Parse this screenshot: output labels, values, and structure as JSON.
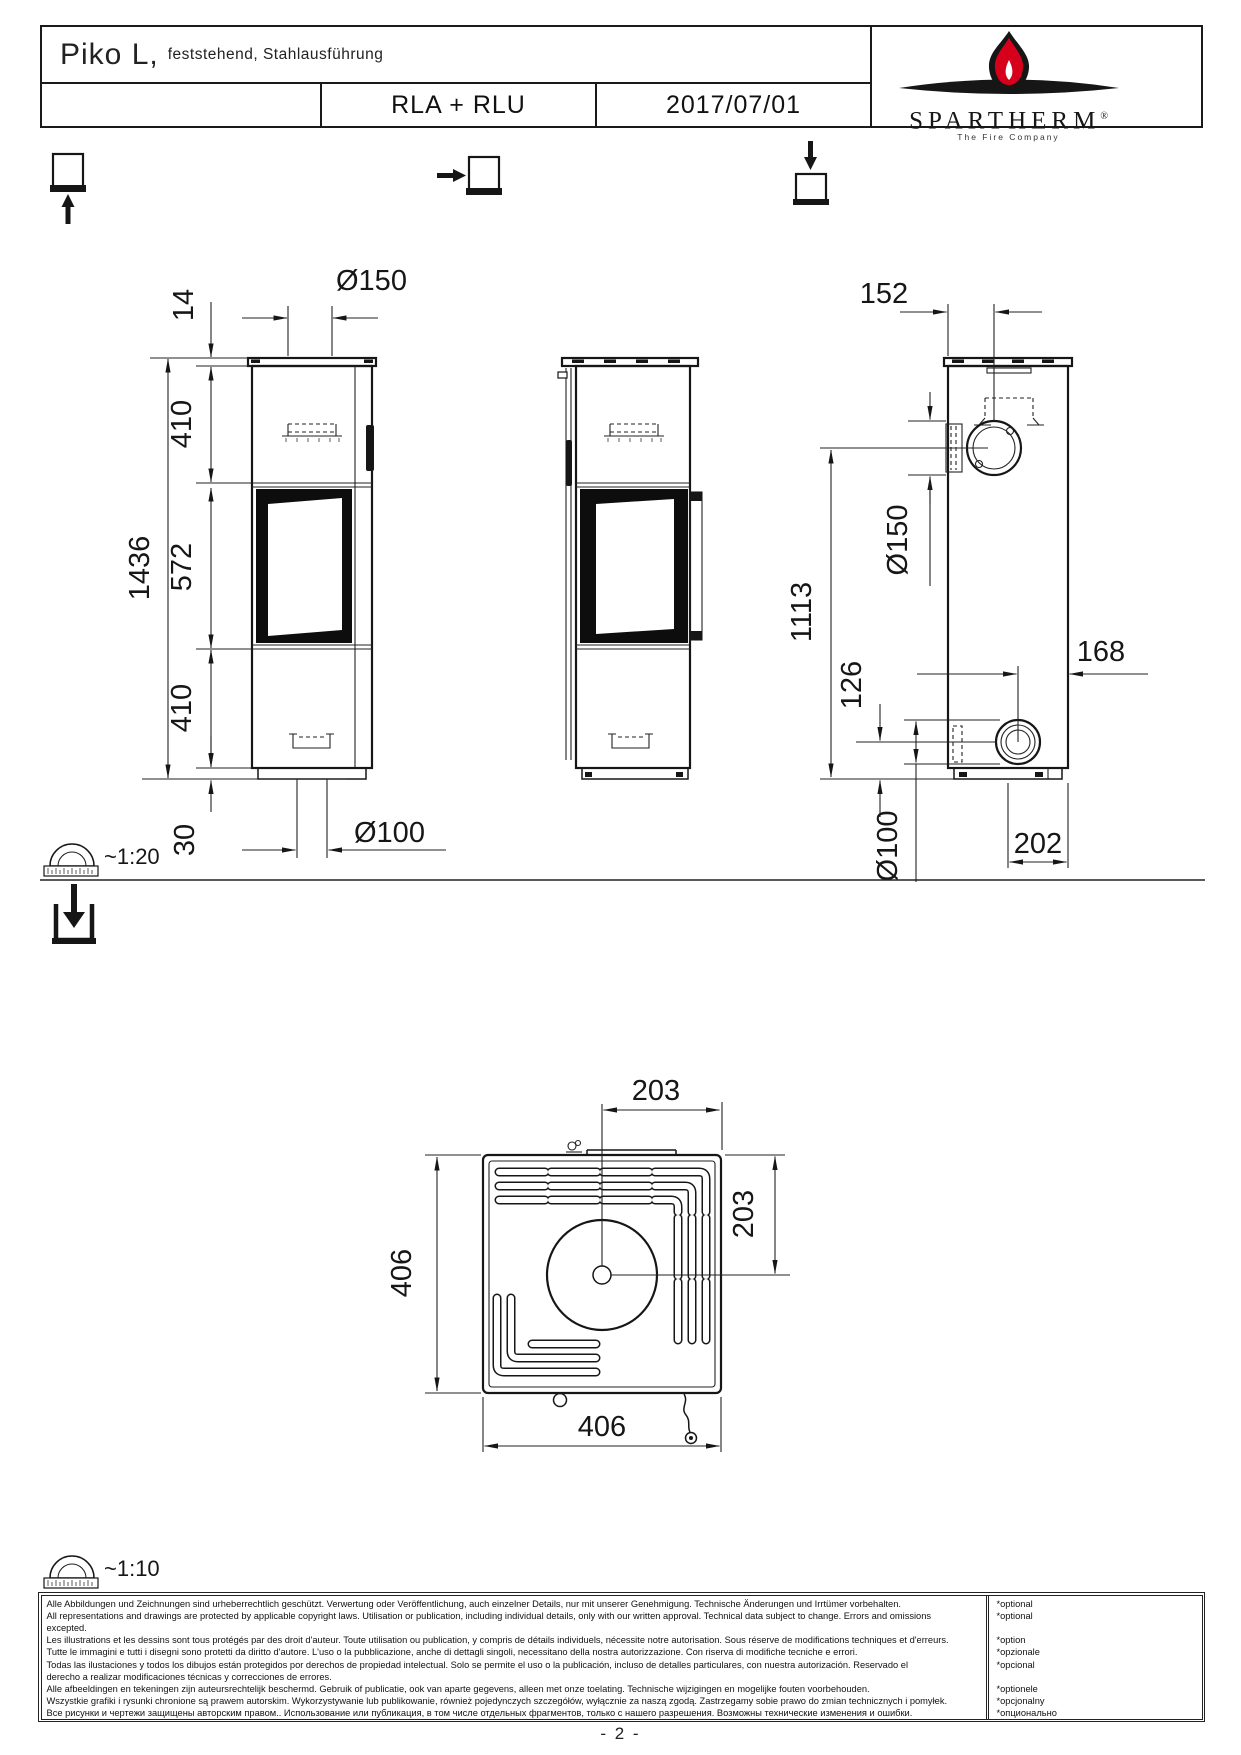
{
  "header": {
    "title": "Piko L,",
    "subtitle": "feststehend, Stahlausführung",
    "model_row": {
      "variant": "RLA + RLU",
      "date": "2017/07/01"
    },
    "brand": {
      "name": "SPARTHERM",
      "registered": "®",
      "tagline": "The Fire Company"
    }
  },
  "views": {
    "front": {
      "dims": {
        "plate_height": "14",
        "upper_height": "410",
        "total_height": "1436",
        "window_height": "572",
        "lower_height": "410",
        "base_height": "30",
        "flue_diameter": "Ø150",
        "air_inlet_diameter": "Ø100"
      }
    },
    "back": {
      "dims": {
        "flue_offset": "152",
        "flue_center_height": "1113",
        "flue_diameter": "Ø150",
        "air_center_height": "126",
        "air_offset": "168",
        "air_diameter": "Ø100",
        "base_depth": "202"
      }
    },
    "top": {
      "dims": {
        "flue_offset_x": "203",
        "flue_offset_y": "203",
        "width": "406",
        "depth": "406"
      }
    }
  },
  "scales": {
    "elevation": "~1:20",
    "plan": "~1:10"
  },
  "disclaimer": {
    "lines": [
      "Alle Abbildungen und Zeichnungen sind urheberrechtlich geschützt. Verwertung oder Veröffentlichung, auch einzelner Details, nur mit unserer Genehmigung. Technische Änderungen und Irrtümer vorbehalten.",
      "All representations and drawings are protected by applicable copyright laws. Utilisation or publication, including individual details, only with our written approval. Technical data subject to change. Errors and omissions",
      "excepted.",
      "Les illustrations et les dessins sont tous protégés par des droit d'auteur. Toute utilisation ou publication, y compris de détails individuels, nécessite notre autorisation. Sous réserve de modifications techniques et d'erreurs.",
      "Tutte le immagini e tutti i disegni sono protetti da diritto d'autore. L'uso o la pubblicazione, anche di dettagli singoli, necessitano della nostra autorizzazione. Con riserva di modifiche tecniche e errori.",
      "Todas las ilustaciones y todos los dibujos están protegidos por derechos de propiedad intelectual. Solo se permite el uso o la publicación, incluso de detalles particulares, con nuestra autorización. Reservado el",
      "derecho a realizar modificaciones técnicas y correcciones de errores.",
      "Alle afbeeldingen en tekeningen zijn auteursrechtelijk beschermd. Gebruik of publicatie, ook van aparte gegevens, alleen met onze toelating. Technische wijzigingen en mogelijke fouten voorbehouden.",
      "Wszystkie grafiki i rysunki chronione są prawem autorskim. Wykorzystywanie lub publikowanie, również pojedynczych szczegółów, wyłącznie za naszą zgodą. Zastrzegamy sobie prawo do zmian technicznych i pomyłek.",
      "Все рисунки и чертежи защищены авторским правом.. Использование или публикация, в том числе отдельных фрагментов, только с нашего разрешения. Возможны технические изменения и ошибки."
    ],
    "options": [
      "*optional",
      "*optional",
      "",
      "*option",
      "*opzionale",
      "*opcional",
      "",
      "*optionele",
      "*opcjonalny",
      "*опционально"
    ]
  },
  "footer": {
    "page_number": "- 2 -"
  }
}
